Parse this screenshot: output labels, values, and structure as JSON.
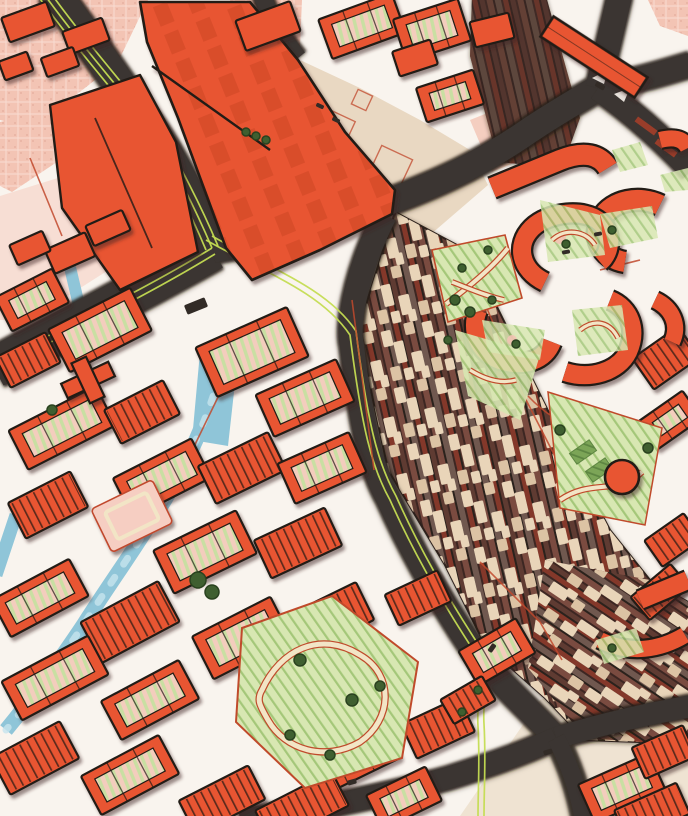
{
  "title": "Illustrated city map with station, railway yard, canals and old town",
  "map": {
    "style": "hand-drawn-illustrated",
    "features": [
      "station-complex",
      "railway-yard",
      "railway-north-corridor",
      "canal",
      "road-network",
      "bike-paths",
      "old-town-blocks",
      "curved-apartment-buildings",
      "parks",
      "plaza",
      "circle-building",
      "bridge-building",
      "sports-fields",
      "trees",
      "vehicles",
      "pink-districts"
    ]
  },
  "palette": {
    "street": "#F9F4EE",
    "plaza": "#E9D8C2",
    "cream": "#EFE3D2",
    "pink": "#F3C4B4",
    "pinkDot": "#DFA290",
    "building": "#E85431",
    "buildingDark": "#D9482A",
    "ink": "#211C18",
    "road": "#3A3430",
    "roadEdge": "#251E18",
    "lime": "#C4DC52",
    "canal": "#8FC5D8",
    "canalLight": "#C6E4EE",
    "parkFill": "#D8E7B2",
    "parkLine": "#A4C779",
    "lawn": "#7CA557",
    "lawnLine": "#5E8642",
    "tree": "#3F5F30",
    "treeDark": "#2A421F",
    "path": "#F2E5C6",
    "pathEdge": "#C04A2B",
    "brick": "#C1492D",
    "brickDark": "#993D2C",
    "yardGreen": "#C9DFA2",
    "yardPink": "#F3CDBD",
    "railBase": "#5B3A32",
    "railDark": "#2B201C",
    "railBrown": "#6F5850",
    "railRed": "#84392B",
    "railMaroon": "#5E3B33",
    "tie": "#E9D5B9",
    "carBody": "#322B26",
    "pinkPlaza": "#F6CEC2"
  }
}
